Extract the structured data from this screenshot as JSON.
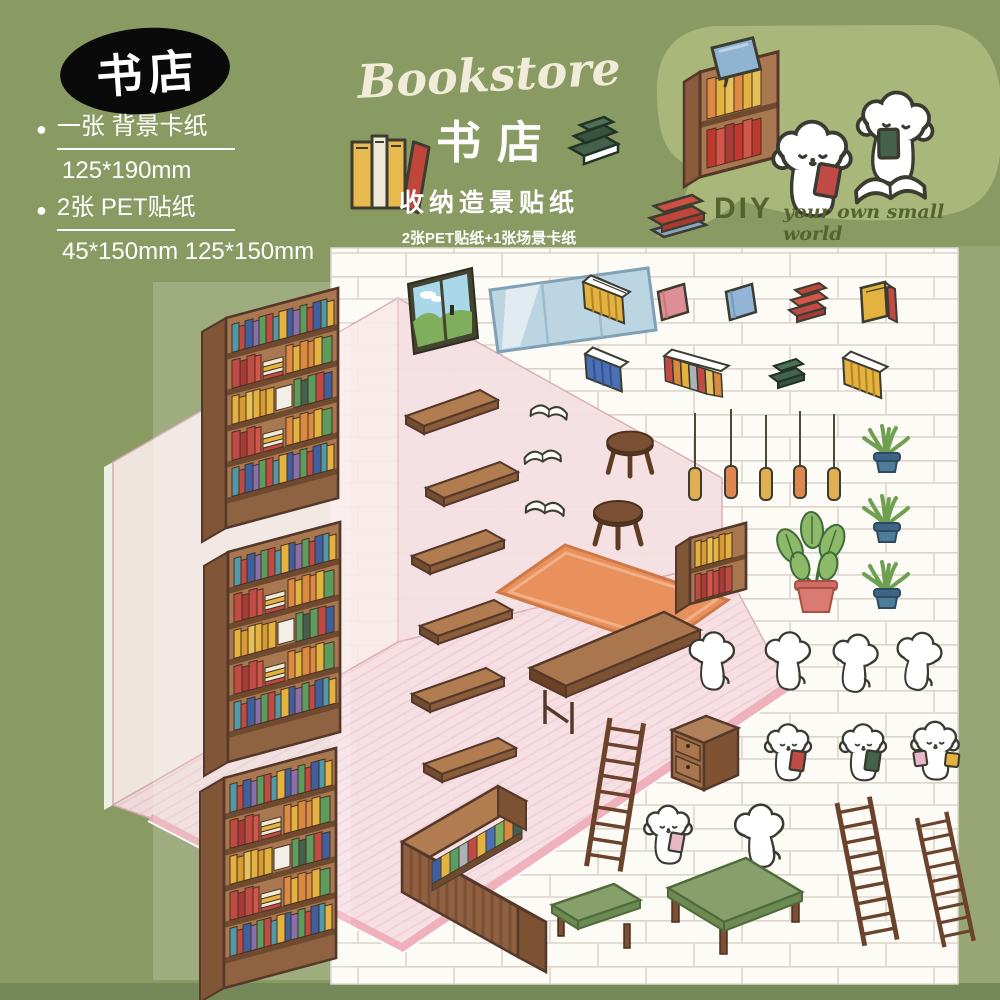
{
  "badge": {
    "text": "书店"
  },
  "specs": {
    "bullet": "●",
    "items": [
      {
        "label": "一张 背景卡纸",
        "size": "125*190mm"
      },
      {
        "label": "2张 PET贴纸",
        "size": "45*150mm 125*150mm"
      }
    ]
  },
  "title": {
    "english": "Bookstore",
    "chinese": "书店",
    "subtitle": "收纳造景贴纸",
    "line": "2张PET贴纸+1张场景卡纸"
  },
  "bubble": {
    "diy": "DIY",
    "tagline": "your own small world"
  },
  "palette": {
    "background": "#8a9a63",
    "speech_bubble": "#a9b77b",
    "badge_black": "#0a0a0a",
    "sheet_white": "#fdfbf5",
    "brick_line": "#dbd4ca",
    "wall_pink": "#f8eae9",
    "floor_pink": "#f6dfe3",
    "floor_edge_pink": "#efadb9",
    "wood_brown": "#aa7850",
    "wood_dark": "#54382a",
    "rug_orange": "#e8915c",
    "table_green": "#87a06b",
    "text_white": "#ffffff",
    "text_cream": "#f0ecd9",
    "diy_green": "#55632e"
  },
  "scene": {
    "items": [
      "bookshelf",
      "wall-shelf-plank",
      "long-desk",
      "rug",
      "stool",
      "open-book",
      "window-art",
      "glass-panel",
      "book-row",
      "book-stack",
      "standing-card",
      "pendant-lamp",
      "potted-plant",
      "small-bookshelf",
      "drawer-cabinet",
      "puppy",
      "ladder",
      "green-table",
      "green-bench",
      "l-shaped-counter"
    ]
  }
}
